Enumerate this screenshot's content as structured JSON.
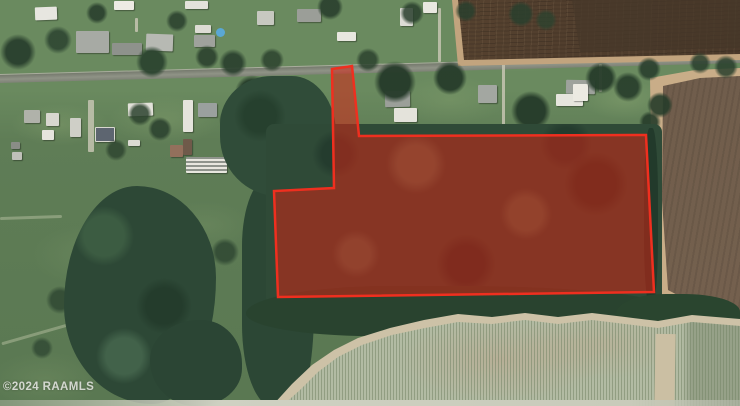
{
  "map": {
    "type": "satellite-aerial",
    "watermark": "©2024 RAAMLS",
    "parcel": {
      "points": "332,69 352,66 359,136 646,135 654,292 278,297 274,191 334,188",
      "fill": "rgba(216,34,20,0.52)",
      "stroke": "#ef2f1f",
      "stroke_width": "2.5"
    },
    "scene": {
      "regions": [
        "residential street with houses along top",
        "plowed brown field top-right",
        "plowed brown field right edge",
        "wooded highlighted parcel center",
        "forest patches left and below parcel",
        "row-crop field bottom",
        "open grass fields left"
      ],
      "colors": {
        "grass": "#63805a",
        "forest": "#2d4836",
        "road": "#878b7e",
        "plowed_field": "#5a4735",
        "crop_rows": "#b2bba3",
        "dirt_path": "#cdc2a7",
        "pool": "#5aa7d4"
      }
    }
  }
}
